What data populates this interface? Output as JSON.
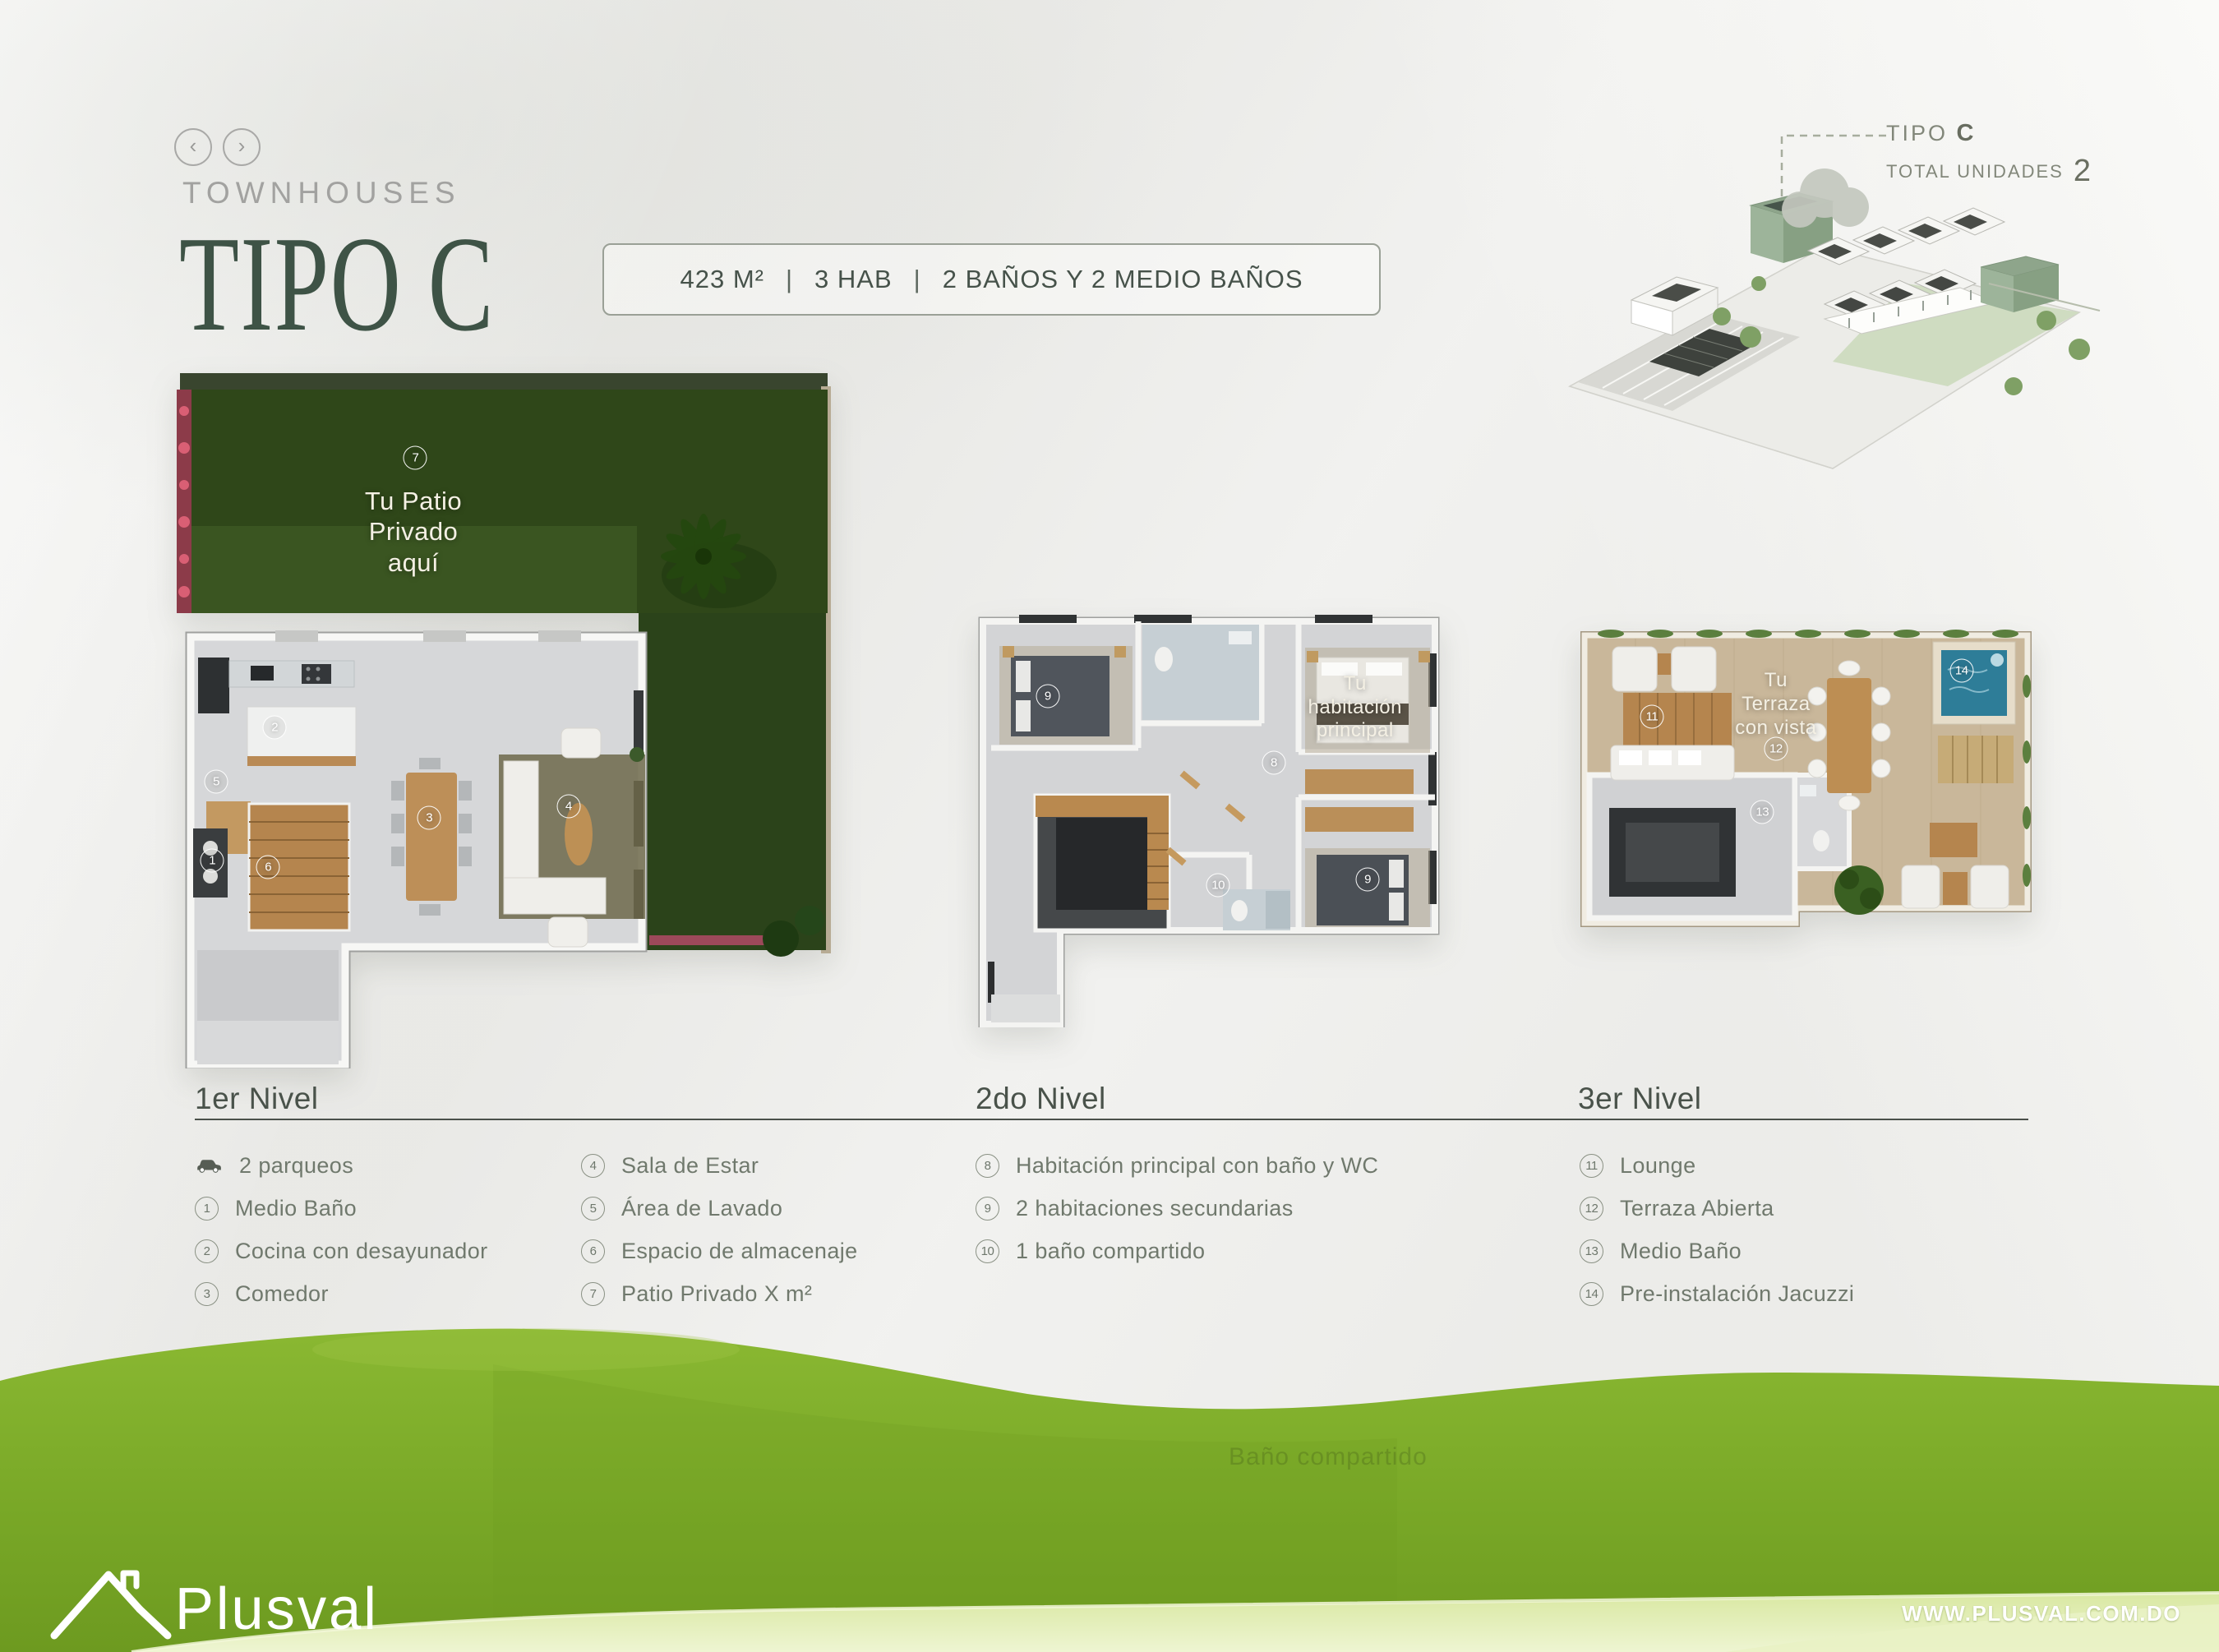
{
  "colors": {
    "accent_green": "#3e5346",
    "heading_gray_green": "#49524a",
    "legend_text": "#70796d",
    "muted_gray": "#a2a2a0",
    "hill_green": "#7dab2c",
    "patio_green": "#2f4719",
    "pool_blue": "#2e7d98",
    "flower_pink": "#c94f63"
  },
  "header": {
    "nav_prev": "‹",
    "nav_next": "›",
    "category": "TOWNHOUSES",
    "title": "TIPO C",
    "spec_area": "423 M²",
    "spec_hab": "3 HAB",
    "spec_banos": "2 BAÑOS Y 2 MEDIO BAÑOS",
    "spec_sep": "|"
  },
  "unit_info": {
    "type_label": "TIPO",
    "type_value": "C",
    "total_label": "TOTAL UNIDADES",
    "total_value": "2"
  },
  "plans": [
    {
      "name": "1er Nivel",
      "labels": [
        {
          "text": "Tu Patio\nPrivado\naquí",
          "x": 36.0,
          "y": 23.2
        }
      ],
      "markers": [
        {
          "num": "7",
          "x": 36.3,
          "y": 12.6
        },
        {
          "num": "2",
          "x": 14.9,
          "y": 51.2
        },
        {
          "num": "5",
          "x": 6.0,
          "y": 58.9
        },
        {
          "num": "1",
          "x": 5.4,
          "y": 70.2
        },
        {
          "num": "6",
          "x": 13.9,
          "y": 71.2
        },
        {
          "num": "3",
          "x": 38.4,
          "y": 64.1
        },
        {
          "num": "4",
          "x": 59.6,
          "y": 62.5
        }
      ]
    },
    {
      "name": "2do Nivel",
      "labels": [
        {
          "text": "Tu\nhabitación\nprincipal",
          "x": 81.2,
          "y": 23.7
        }
      ],
      "markers": [
        {
          "num": "9",
          "x": 15.0,
          "y": 21.0
        },
        {
          "num": "8",
          "x": 63.7,
          "y": 36.9
        },
        {
          "num": "10",
          "x": 51.7,
          "y": 66.1
        },
        {
          "num": "9",
          "x": 83.9,
          "y": 64.7
        }
      ]
    },
    {
      "name": "3er Nivel",
      "labels": [
        {
          "text": "Tu\nTerraza\ncon vista",
          "x": 43.4,
          "y": 26.2
        }
      ],
      "markers": [
        {
          "num": "11",
          "x": 16.2,
          "y": 30.0
        },
        {
          "num": "12",
          "x": 43.4,
          "y": 40.0
        },
        {
          "num": "13",
          "x": 40.4,
          "y": 59.7
        },
        {
          "num": "14",
          "x": 84.1,
          "y": 15.6
        }
      ]
    }
  ],
  "legend": [
    {
      "title": "1er Nivel",
      "columns": [
        [
          {
            "marker": "car",
            "label": "2 parqueos"
          },
          {
            "marker": "1",
            "label": "Medio Baño"
          },
          {
            "marker": "2",
            "label": "Cocina con desayunador"
          },
          {
            "marker": "3",
            "label": "Comedor"
          }
        ],
        [
          {
            "marker": "4",
            "label": "Sala de Estar"
          },
          {
            "marker": "5",
            "label": "Área de Lavado"
          },
          {
            "marker": "6",
            "label": "Espacio de almacenaje"
          },
          {
            "marker": "7",
            "label": "Patio Privado X m²"
          }
        ]
      ]
    },
    {
      "title": "2do Nivel",
      "columns": [
        [
          {
            "marker": "8",
            "label": "Habitación principal con baño y WC"
          },
          {
            "marker": "9",
            "label": "2 habitaciones secundarias"
          },
          {
            "marker": "10",
            "label": "1 baño compartido"
          }
        ]
      ]
    },
    {
      "title": "3er Nivel",
      "columns": [
        [
          {
            "marker": "11",
            "label": "Lounge"
          },
          {
            "marker": "12",
            "label": "Terraza Abierta"
          },
          {
            "marker": "13",
            "label": "Medio Baño"
          },
          {
            "marker": "14",
            "label": "Pre-instalación Jacuzzi"
          }
        ]
      ]
    }
  ],
  "footer": {
    "logo_text": "Plusval",
    "website": "WWW.PLUSVAL.COM.DO",
    "ghost_text": "Baño compartido"
  }
}
